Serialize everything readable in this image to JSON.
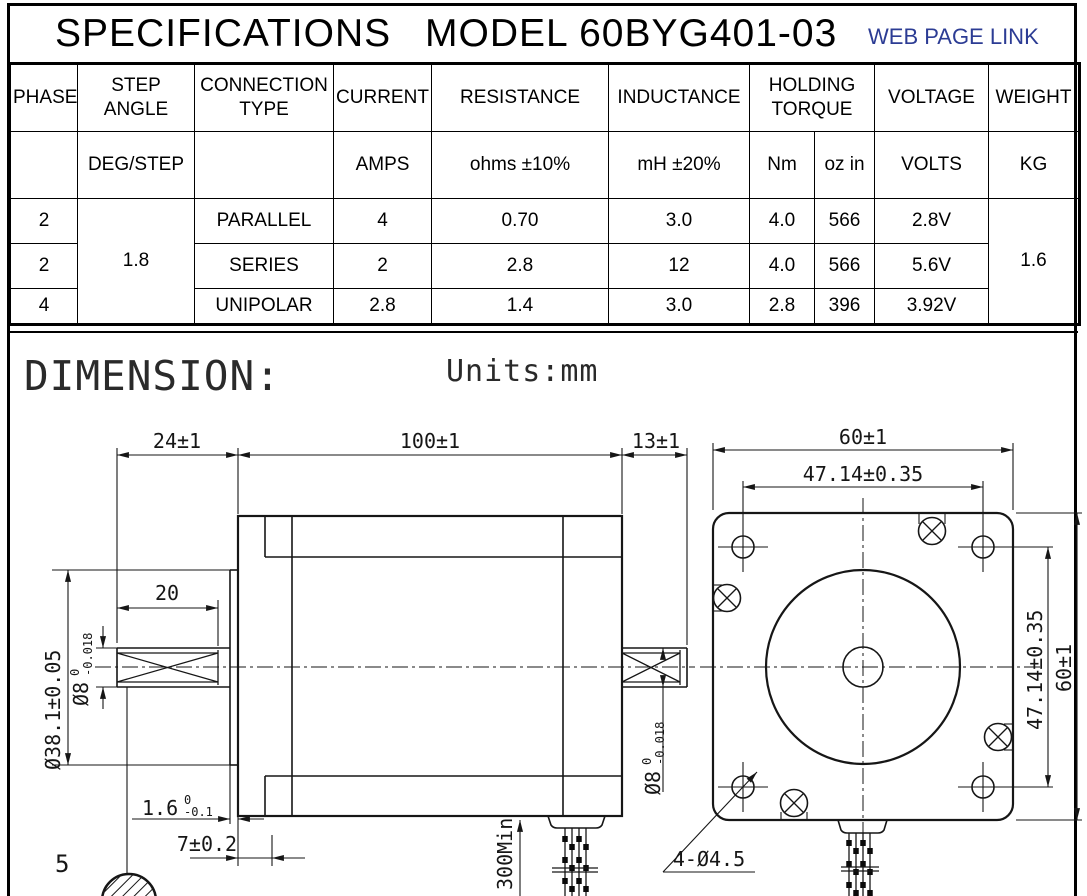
{
  "header": {
    "title": "SPECIFICATIONS",
    "model": "MODEL 60BYG401-03",
    "link_label": "WEB PAGE LINK",
    "link_color": "#2c3c94"
  },
  "spec_table": {
    "headers": {
      "phase": "PHASE",
      "step_angle": "STEP ANGLE",
      "connection": "CONNECTION TYPE",
      "current": "CURRENT",
      "resistance": "RESISTANCE",
      "inductance": "INDUCTANCE",
      "holding_torque": "HOLDING TORQUE",
      "voltage": "VOLTAGE",
      "weight": "WEIGHT"
    },
    "units": {
      "step_angle": "DEG/STEP",
      "current": "AMPS",
      "resistance": "ohms ±10%",
      "inductance": "mH ±20%",
      "torque_nm": "Nm",
      "torque_ozin": "oz in",
      "voltage": "VOLTS",
      "weight": "KG"
    },
    "step_angle_value": "1.8",
    "weight_value": "1.6",
    "rows": [
      {
        "phase": "2",
        "connection": "PARALLEL",
        "current": "4",
        "resistance": "0.70",
        "inductance": "3.0",
        "nm": "4.0",
        "ozin": "566",
        "voltage": "2.8V"
      },
      {
        "phase": "2",
        "connection": "SERIES",
        "current": "2",
        "resistance": "2.8",
        "inductance": "12",
        "nm": "4.0",
        "ozin": "566",
        "voltage": "5.6V"
      },
      {
        "phase": "4",
        "connection": "UNIPOLAR",
        "current": "2.8",
        "resistance": "1.4",
        "inductance": "3.0",
        "nm": "2.8",
        "ozin": "396",
        "voltage": "3.92V"
      }
    ]
  },
  "dimension_section": {
    "heading": "DIMENSION:",
    "units_note": "Units:mm"
  },
  "drawing": {
    "side_view": {
      "shaft_len": "24±1",
      "body_len": "100±1",
      "rear_shaft_len": "13±1",
      "flat_len": "20",
      "boss_dia": "Ø38.1±0.05",
      "shaft_dia": "Ø8",
      "shaft_dia_tol_top": "0",
      "shaft_dia_tol_bot": "-0.018",
      "boss_height": "1.6",
      "boss_height_tol_top": "0",
      "boss_height_tol_bot": "-0.1",
      "pilot_depth": "7±0.2",
      "cable_len": "300Min",
      "section_label": "5",
      "rear_shaft_dia": "Ø8",
      "rear_shaft_dia_tol_top": "0",
      "rear_shaft_dia_tol_bot": "-0.018"
    },
    "front_view": {
      "width": "60±1",
      "hole_spacing_h": "47.14±0.35",
      "hole_spacing_v": "47.14±0.35",
      "height": "60±1",
      "mounting_holes": "4-Ø4.5"
    }
  }
}
